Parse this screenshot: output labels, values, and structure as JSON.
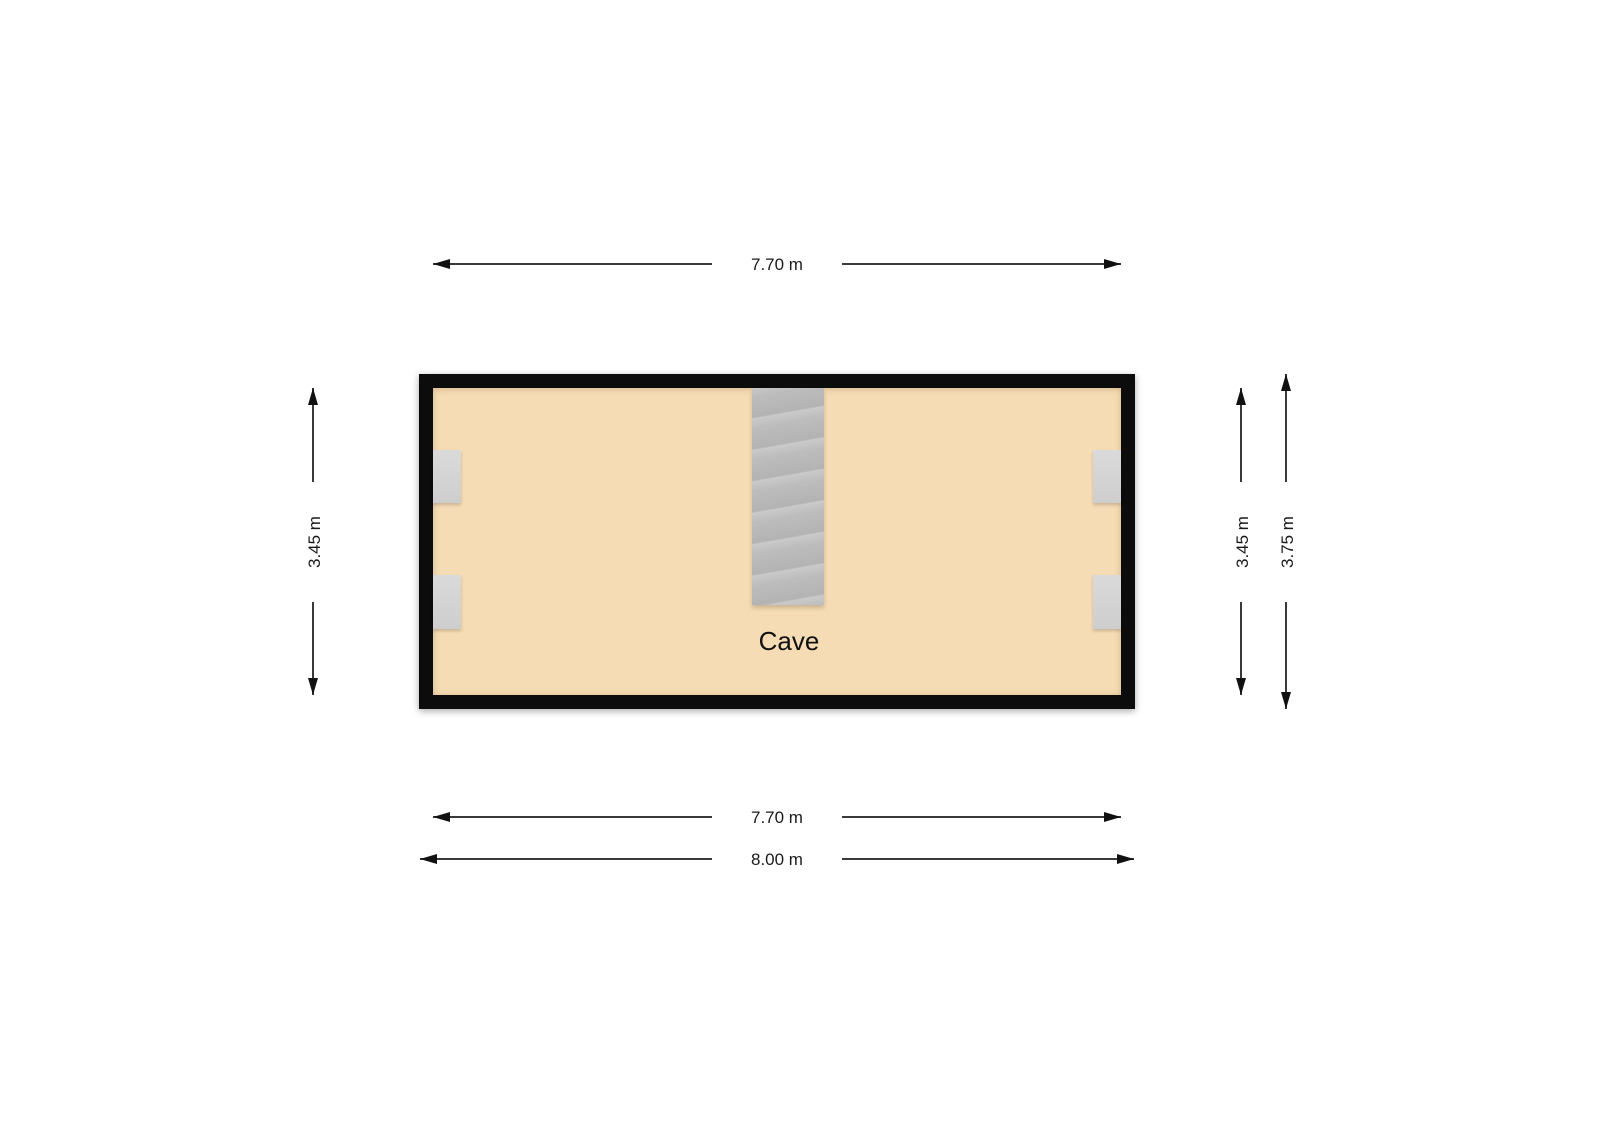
{
  "room": {
    "label": "Cave"
  },
  "dimensions": {
    "top_width": "7.70 m",
    "bottom_width_inner": "7.70 m",
    "bottom_width_outer": "8.00 m",
    "left_height": "3.45 m",
    "right_height_inner": "3.45 m",
    "right_height_outer": "3.75 m"
  },
  "features": {
    "staircase": "staircase",
    "windows": [
      "window-left-top",
      "window-left-bottom",
      "window-right-top",
      "window-right-bottom"
    ]
  },
  "colors": {
    "background": "#ffffff",
    "wall": "#0c0c0c",
    "floor": "#f5dcb4",
    "stairs": "#bdbdbd",
    "window": "#d5d5d5",
    "dimension_line": "#3a3a3a",
    "text": "#1a1a1a"
  }
}
